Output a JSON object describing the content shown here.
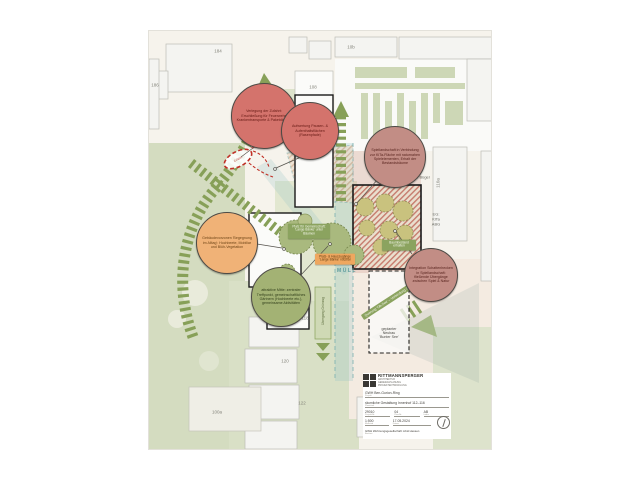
{
  "bubbles": [
    {
      "text": "Verlegung der Zufahrt: Erschließung für Feuerwehr, Krankentransporte & Paketdienste"
    },
    {
      "text": "Aufwertung Pausen- & Aufenthaltsflächen (Rasenpfade)"
    },
    {
      "text": "Spiellandschaft in Verbindung zur KiTa-Fläche mit naturnahen Spielelementen, Erhalt der Bestandsbäume"
    },
    {
      "text": "Gebäudevorzonen 'Begegnung im Alltag': Hochbeete, Mobiliar und Blüh-Vegetation"
    },
    {
      "text": "attraktive Mitte: zentraler Treffpunkt, gemeinschaftliches Gärtnern (Hochbeete etc.), gemeinsame Aktivitäten"
    },
    {
      "text": "Integration Schattenhecken in Spiellandschaft: fließende Übergänge zwischen Spiel & Natur"
    }
  ],
  "numbers": [
    "184",
    "186",
    "10b",
    "108",
    "110",
    "112",
    "114",
    "116",
    "118",
    "120",
    "122",
    "100a",
    "110a"
  ],
  "labels": {
    "zentrum": "Zentrum",
    "am_buegel": "Am Bügel",
    "buergerhaus": "Bürgerhaus",
    "eg_kita": "EG:\nKiTa\nABG",
    "muell": "MÜLL",
    "neubau": "geplanter\nNeubau\n'Bunter See'",
    "querung": "Querung 'Ob-See' – Verbindung Grünzug",
    "uebergang": "Übergang Grünzug",
    "fussweg": "Fußweg",
    "zufahrt": "Zufahrt",
    "star": "✶"
  },
  "boxes": {
    "gemeinschaft": "Platz für Gemeinschaft: 'Lange Bänke' unter Bäumen",
    "eingang": "Platz- & Hauszugänge 'Lange Bänke' nutzbar",
    "baumbestand": "Baumbestand erhalten"
  },
  "titleblock": {
    "firm": "RITTMANNSPERGER",
    "firm_sub": "ARCHITEKTUR\nGENERALPLANUNG\nPROJEKTENTWICKLUNG",
    "project": "GWH Ben-Gurion-Ring",
    "project_caption": "Projekt",
    "title": "räumliche Gestaltung Innenhof 112–116",
    "title_caption": "Planinhalt",
    "proj_no": "29010",
    "proj_no_caption": "Projekt-Nr.",
    "plan_no": "04",
    "plan_no_caption": "Plan-Nr.",
    "index": "AB",
    "index_caption": "Index",
    "scale": "1:500",
    "scale_caption": "Maßstab",
    "date": "17.05.2024",
    "date_caption": "Datum",
    "client": "GWH Wohnungsgesellschaft mbH Hessen",
    "client_caption": "Bauherr"
  },
  "colors": {
    "arrow_green": "#87a058",
    "bubble_red": "#d4736c",
    "bubble_rose": "#c28d85",
    "bubble_orange": "#f0b277",
    "bubble_olive": "#a3b274",
    "corridor_teal": "#79b0b0",
    "red_mark": "#c03026"
  }
}
